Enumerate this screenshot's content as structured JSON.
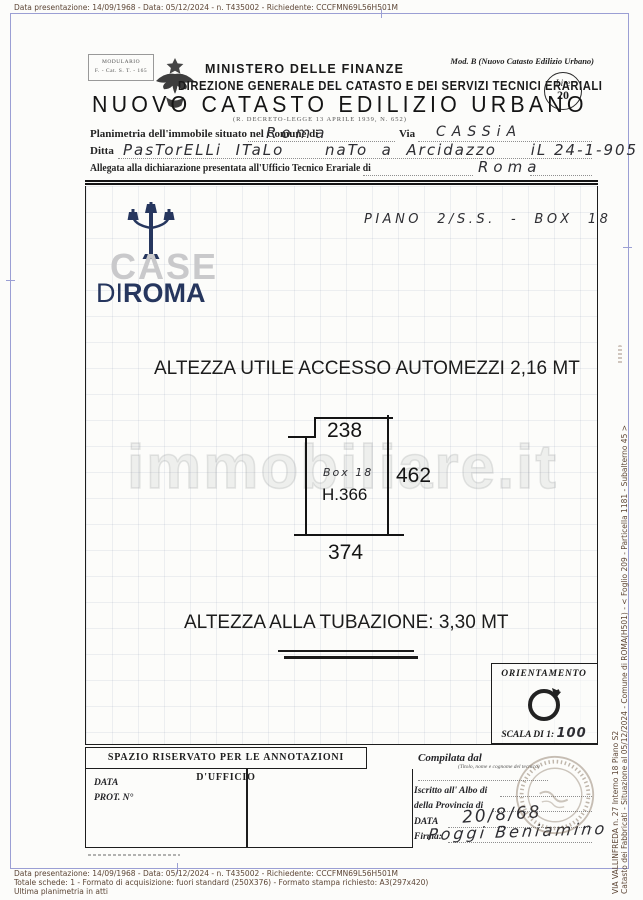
{
  "margins": {
    "top_line": "Data presentazione: 14/09/1968 - Data: 05/12/2024 - n. T435002 - Richiedente: CCCFMN69L56H501M",
    "bottom_lines": [
      "Data presentazione: 14/09/1968 - Data: 05/12/2024 - n. T435002 - Richiedente: CCCFMN69L56H501M",
      "Totale schede: 1 - Formato di acquisizione: fuori standard (250X376) - Formato stampa richiesto: A3(297x420)",
      "Ultima planimetria in atti"
    ],
    "side_line1": "Catasto dei Fabbricati - Situazione al 05/12/2024 - Comune di ROMA(H501) - < Foglio 209 - Particella 1181 - Subalterno 45 >",
    "side_line2": "VIA VALLINFREDA n. 27 Interno 18 Piano S2"
  },
  "header": {
    "modulario_line1": "MODULARIO",
    "modulario_line2": "F. - Cat. S. T. - 165",
    "mod_b": "Mod. B (Nuovo Catasto Edilizio Urbano)",
    "ministero": "MINISTERO DELLE FINANZE",
    "direzione": "DIREZIONE GENERALE DEL CATASTO E DEI SERVIZI TECNICI ERARIALI",
    "title": "NUOVO CATASTO EDILIZIO URBANO",
    "decree": "(R. DECRETO-LEGGE 13 APRILE 1939, N. 652)",
    "lire_label": "Lire",
    "lire_value": "20"
  },
  "form": {
    "row1_label": "Planimetria dell'immobile situato nel Comune di",
    "comune_value": "Roma",
    "via_label": "Via",
    "via_value": "CASSiA",
    "ditta_label": "Ditta",
    "ditta_value": "PasTorELLi  ITaLo      naTo  a  Arcidazzo     iL 24-1-905",
    "row3_label": "Allegata alla dichiarazione presentata all'Ufficio Tecnico Erariale di",
    "ufficio_value": "Roma"
  },
  "plan": {
    "piano_note": "PIANO  2/S.S.  -  BOX  18",
    "altezza_accesso": "ALTEZZA UTILE ACCESSO AUTOMEZZI 2,16 MT",
    "altezza_tubazione": "ALTEZZA ALLA TUBAZIONE: 3,30 MT",
    "dim_top": "238",
    "dim_right": "462",
    "dim_bottom": "374",
    "box_label": "Box 18",
    "height_label": "H.366",
    "orientamento": "ORIENTAMENTO",
    "scala_label": "SCALA DI 1:",
    "scala_value": "100"
  },
  "watermark": {
    "case": "CASE",
    "di": "DI",
    "roma": "ROMA",
    "immobiliare": "immobiliare.it"
  },
  "office": {
    "annotations_title": "SPAZIO RISERVATO PER LE ANNOTAZIONI D'UFFICIO",
    "data_label": "DATA",
    "prot_label": "PROT. N°",
    "compilata_label": "Compilata dal",
    "compilata_note": "(Titolo, nome e cognome del tecnico)",
    "iscritto_label": "Iscritto all' Albo di",
    "provincia_label": "della Provincia di",
    "data2_label": "DATA",
    "data_value": "20/8/68",
    "firma_label": "Firma:",
    "firma_value": "Poggi Beniamino"
  },
  "colors": {
    "navy": "#26365e",
    "frame_blue": "#9b9fd4",
    "margin_text": "#5d4636"
  }
}
